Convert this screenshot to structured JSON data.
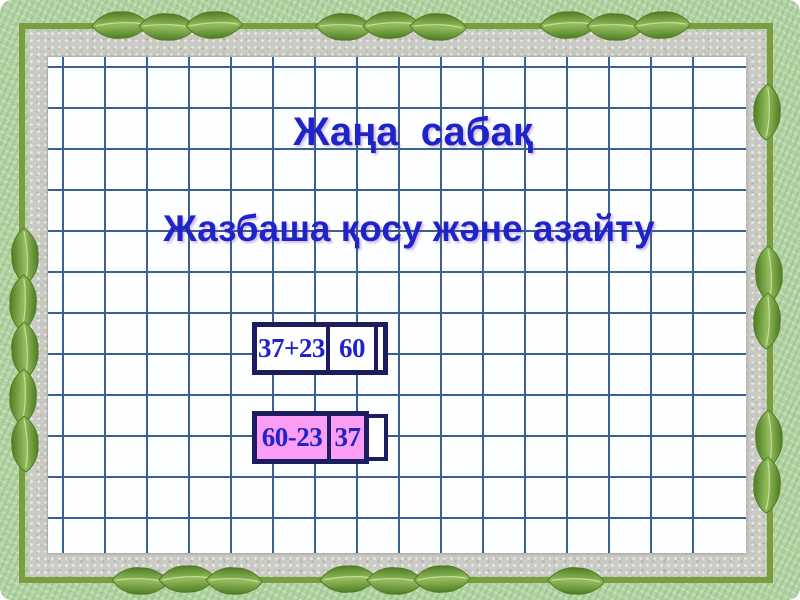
{
  "slide": {
    "title": "Жаңа  сабақ",
    "subtitle": "Жазбаша қосу және азайту"
  },
  "problems": [
    {
      "expression": "37+23",
      "result": "60",
      "highlighted": false
    },
    {
      "expression": "60-23",
      "result": "37",
      "highlighted": true
    }
  ],
  "colors": {
    "frame_green": "#b4d6a6",
    "stem_green": "#7c9c42",
    "leaf_dark": "#4f7d24",
    "leaf_light": "#93bd5c",
    "mat_gray": "#cbcbc5",
    "paper_white": "#fdfeff",
    "grid_blue": "#3a6191",
    "text_blue": "#1f24c8",
    "navy": "#1c1c60",
    "pink": "#fb9df2"
  }
}
